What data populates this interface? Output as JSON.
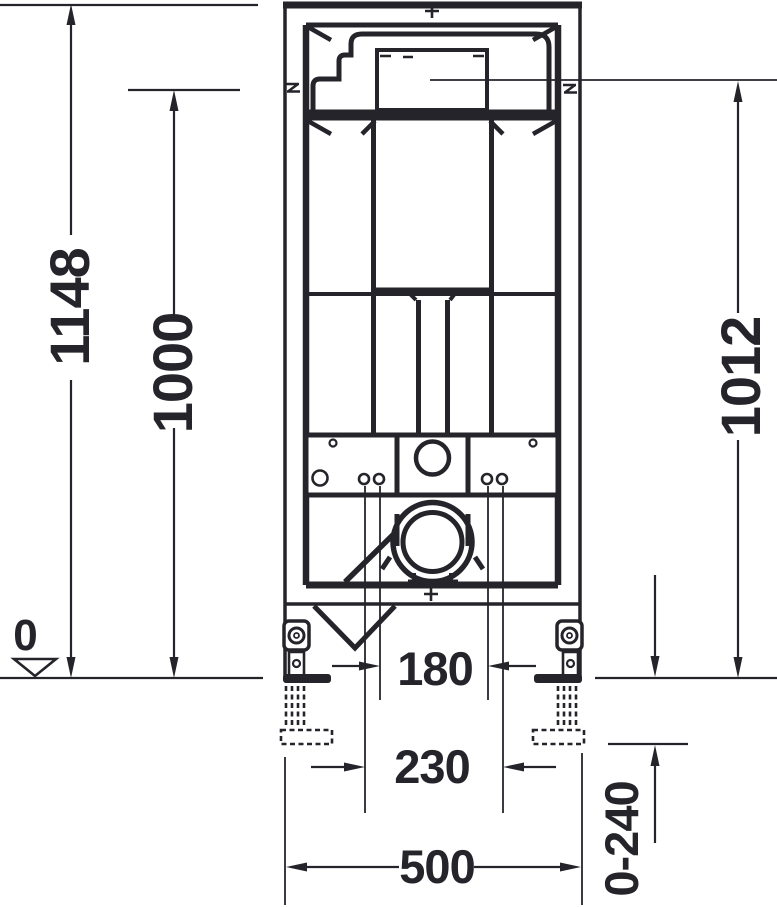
{
  "drawing": {
    "dims": {
      "overall_height": "1148",
      "upper_fixing_height": "1000",
      "actuator_center_height": "1012",
      "floor_zero_level": "0",
      "fixing_bolt_spacing_inner": "180",
      "fixing_bolt_spacing_outer": "230",
      "frame_width": "500",
      "leg_adjustment_range": "0-240"
    },
    "symbols": {
      "floor_level_marker": "open-triangle-down",
      "rail_alignment_mark": "z-mark",
      "center_mark": "cross"
    },
    "colors": {
      "ink": "#26242b",
      "paper": "#ffffff"
    }
  }
}
